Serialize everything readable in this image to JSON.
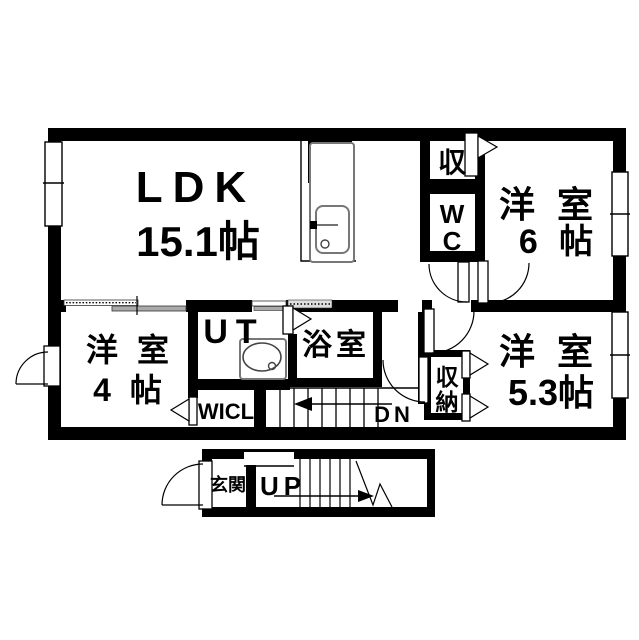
{
  "floorplan": {
    "rooms": {
      "ldk": {
        "name": "LDK",
        "size": "15.1帖"
      },
      "bedroom6": {
        "name": "洋 室",
        "size": "6 帖"
      },
      "bedroom4": {
        "name": "洋 室",
        "size": "4 帖"
      },
      "bedroom53": {
        "name": "洋 室",
        "size": "5.3帖"
      },
      "utility": {
        "name": "UT"
      },
      "bath": {
        "name": "浴室"
      },
      "wc": {
        "line1": "W",
        "line2": "C"
      },
      "closet_top": {
        "name": "収"
      },
      "closet_side": {
        "line1": "収",
        "line2": "納"
      },
      "wicl": {
        "name": "WICL"
      },
      "genkan": {
        "name": "玄関"
      }
    },
    "stairs": {
      "down_label": "DN",
      "up_label": "UP"
    },
    "colors": {
      "wall": "#000000",
      "floor": "#ffffff",
      "fixture_outline": "#777777"
    }
  }
}
